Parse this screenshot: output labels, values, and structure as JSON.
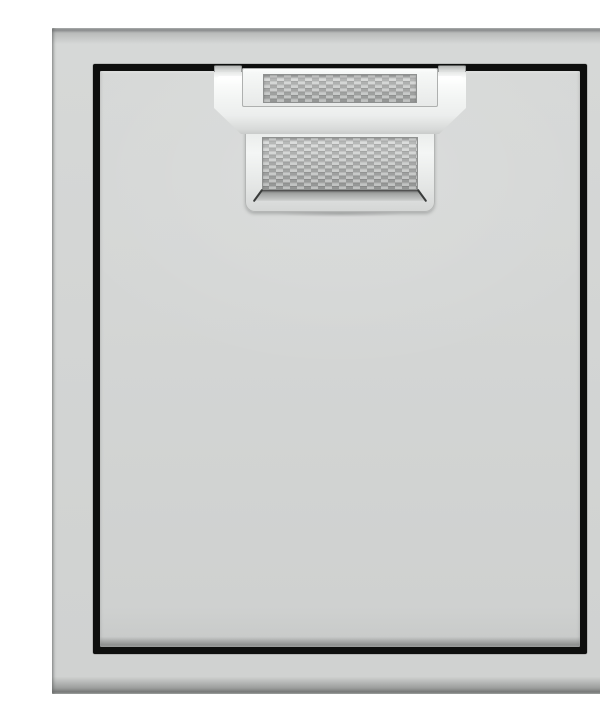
{
  "image": {
    "description": "Product photo of a brushed stainless steel single access door set in a square steel frame on a white background. A bright steel pull handle with a woven metal texture inlay is mounted at the top center of the door, crossing the thin black reveal gap that outlines the door panel.",
    "alt": "Stainless steel access door with woven-texture handle"
  },
  "parts": {
    "frame": "steel surround frame",
    "reveal": "black reveal gap",
    "panel": "door panel",
    "handle": "pull handle",
    "grip": "grip bar",
    "channel": "recessed channel with woven inlay",
    "backplate": "woven-texture back plate"
  },
  "colors": {
    "background": "#ffffff",
    "steel": "#d3d5d4",
    "steel_edge_dark": "#8e908f",
    "reveal_black": "#0e0f0e",
    "handle_bright": "#f3f5f4",
    "mesh_base": "#bcbebd",
    "mesh_light": "#d3d5d4",
    "mesh_dark": "#a2a4a3",
    "bevel_dark": "#3a3c3b"
  }
}
